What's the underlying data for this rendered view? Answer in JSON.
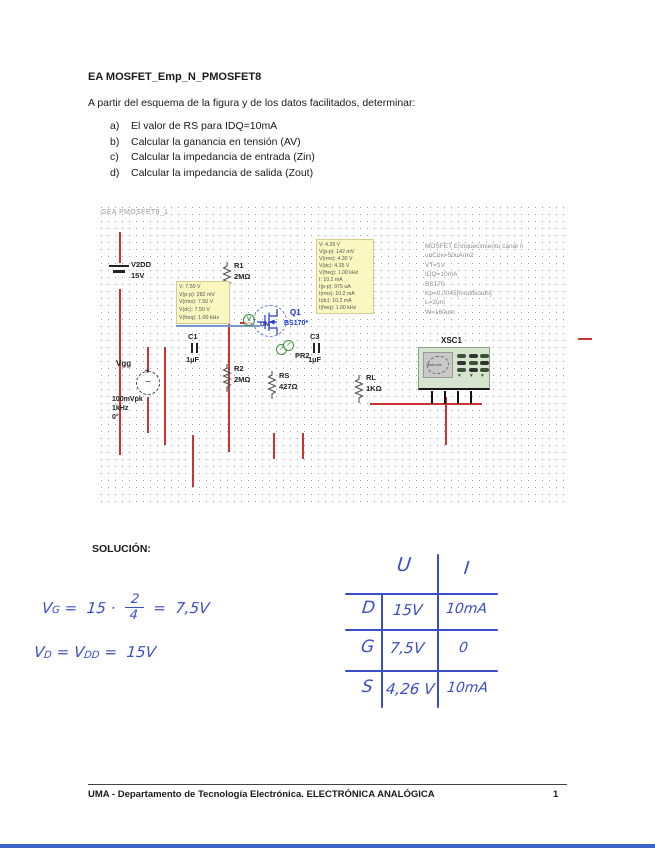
{
  "page": {
    "title": "EA MOSFET_Emp_N_PMOSFET8",
    "intro": "A partir del esquema de la figura y de los datos facilitados, determinar:",
    "items": [
      {
        "label": "a)",
        "text": "El valor de RS para IDQ=10mA"
      },
      {
        "label": "b)",
        "text": "Calcular la ganancia en tensión (AV)"
      },
      {
        "label": "c)",
        "text": "Calcular la impedancia de entrada (Zin)"
      },
      {
        "label": "d)",
        "text": "Calcular la impedancia de salida (Zout)"
      }
    ]
  },
  "icons": {
    "voltage_probe": "V",
    "probe_arrow": "↗",
    "sine": "~",
    "plus": "+",
    "scope_button_arrow": "▾"
  },
  "schematic": {
    "title": "GEA PMOSFET8_1",
    "components": {
      "v2dd": {
        "ref": "V2DD",
        "value": "15V"
      },
      "vgg": {
        "ref": "Vgg",
        "value_lines": [
          "100mVpk",
          "1kHz",
          "0°"
        ]
      },
      "r1": {
        "ref": "R1",
        "value": "2MΩ"
      },
      "r2": {
        "ref": "R2",
        "value": "2MΩ"
      },
      "rs": {
        "ref": "RS",
        "value": "427Ω"
      },
      "rl": {
        "ref": "RL",
        "value": "1KΩ"
      },
      "c1": {
        "ref": "C1",
        "value": "1µF"
      },
      "c3": {
        "ref": "C3",
        "value": "1µF"
      },
      "q1": {
        "ref": "Q1",
        "value": "BS170*",
        "net": "DM"
      },
      "pr2": {
        "ref": "PR2"
      },
      "xsc1": {
        "ref": "XSC1",
        "screen_brand": "Tektronix"
      }
    },
    "probe_box_left": {
      "lines": [
        "V: 7.50 V",
        "V(p-p): 282 mV",
        "V(rms): 7.50 V",
        "V(dc): 7.50 V",
        "V(freq): 1.00 kHz"
      ]
    },
    "probe_box_mid": {
      "lines": [
        "V: 4.26 V",
        "V(p-p): 142 mV",
        "V(rms): 4.30 V",
        "V(dc): 4.35 V",
        "V(freq): 1.00 kHz",
        "I: 10.2 mA",
        "I(p-p): 975 uA",
        "I(rms): 10.2 mA",
        "I(dc): 10.2 mA",
        "I(freq): 1.00 kHz"
      ]
    },
    "notes": [
      "MOSFET Enriquecimiento canal n",
      "unCox=50uA/m2",
      "VT=1V",
      "IDQ=10mA",
      "BS170",
      "Kp=0,0045[modificado]",
      "L=2um",
      "W=160um"
    ]
  },
  "solution": {
    "heading": "SOLUCIÓN:",
    "eq1": {
      "lead": "V",
      "lead_sub": "G",
      "mid": " =  15 · ",
      "num": "2",
      "den": "4",
      "tail": " =  7,5V"
    },
    "eq2": {
      "lead": "V",
      "lead_sub": "D",
      "mid": " = V",
      "mid_sub": "DD",
      "tail": " =  15V"
    }
  },
  "table": {
    "col_headers": [
      "U",
      "I"
    ],
    "rows": [
      {
        "label": "D",
        "u": "15V",
        "i": "10mA"
      },
      {
        "label": "G",
        "u": "7,5V",
        "i": "0"
      },
      {
        "label": "S",
        "u": "4,26 V",
        "i": "10mA"
      }
    ]
  },
  "footer": {
    "text": "UMA - Departamento de Tecnología Electrónica. ELECTRÓNICA ANALÓGICA",
    "page_number": "1"
  }
}
